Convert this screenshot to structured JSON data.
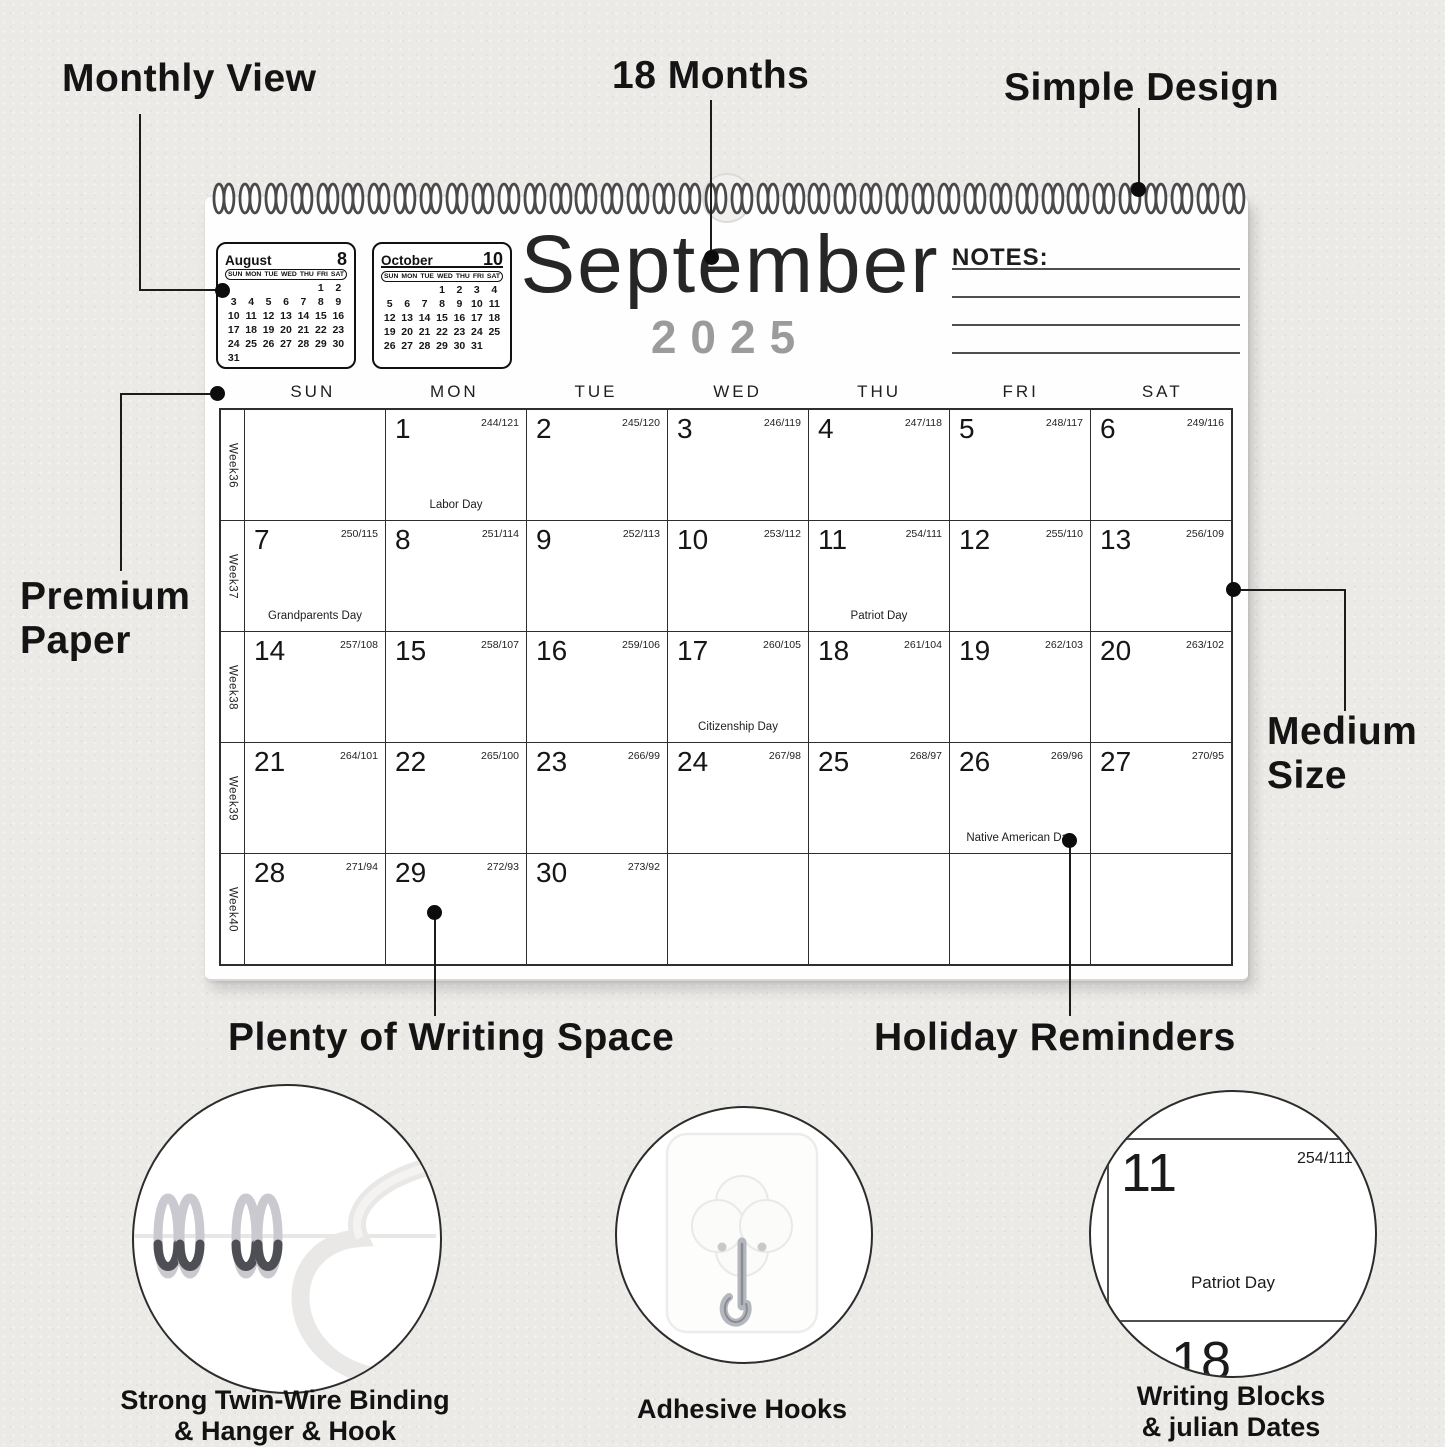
{
  "annotations": {
    "monthly_view": "Monthly View",
    "eighteen_months": "18 Months",
    "simple_design": "Simple Design",
    "premium_paper": [
      "Premium",
      "Paper"
    ],
    "medium_size": [
      "Medium",
      "Size"
    ],
    "writing_space": "Plenty of Writing Space",
    "holiday_reminders": "Holiday Reminders"
  },
  "calendar": {
    "title": "September",
    "year": "2025",
    "notes_label": "NOTES:",
    "day_headers": [
      "SUN",
      "MON",
      "TUE",
      "WED",
      "THU",
      "FRI",
      "SAT"
    ],
    "weeks": [
      {
        "label": "Week36",
        "cells": [
          {},
          {
            "day": "1",
            "julian": "244/121",
            "holiday": "Labor Day"
          },
          {
            "day": "2",
            "julian": "245/120"
          },
          {
            "day": "3",
            "julian": "246/119"
          },
          {
            "day": "4",
            "julian": "247/118"
          },
          {
            "day": "5",
            "julian": "248/117"
          },
          {
            "day": "6",
            "julian": "249/116"
          }
        ]
      },
      {
        "label": "Week37",
        "cells": [
          {
            "day": "7",
            "julian": "250/115",
            "holiday": "Grandparents Day"
          },
          {
            "day": "8",
            "julian": "251/114"
          },
          {
            "day": "9",
            "julian": "252/113"
          },
          {
            "day": "10",
            "julian": "253/112"
          },
          {
            "day": "11",
            "julian": "254/111",
            "holiday": "Patriot Day"
          },
          {
            "day": "12",
            "julian": "255/110"
          },
          {
            "day": "13",
            "julian": "256/109"
          }
        ]
      },
      {
        "label": "Week38",
        "cells": [
          {
            "day": "14",
            "julian": "257/108"
          },
          {
            "day": "15",
            "julian": "258/107"
          },
          {
            "day": "16",
            "julian": "259/106"
          },
          {
            "day": "17",
            "julian": "260/105",
            "holiday": "Citizenship Day"
          },
          {
            "day": "18",
            "julian": "261/104"
          },
          {
            "day": "19",
            "julian": "262/103"
          },
          {
            "day": "20",
            "julian": "263/102"
          }
        ]
      },
      {
        "label": "Week39",
        "cells": [
          {
            "day": "21",
            "julian": "264/101"
          },
          {
            "day": "22",
            "julian": "265/100"
          },
          {
            "day": "23",
            "julian": "266/99"
          },
          {
            "day": "24",
            "julian": "267/98"
          },
          {
            "day": "25",
            "julian": "268/97"
          },
          {
            "day": "26",
            "julian": "269/96",
            "holiday": "Native American Day"
          },
          {
            "day": "27",
            "julian": "270/95"
          }
        ]
      },
      {
        "label": "Week40",
        "cells": [
          {
            "day": "28",
            "julian": "271/94"
          },
          {
            "day": "29",
            "julian": "272/93"
          },
          {
            "day": "30",
            "julian": "273/92"
          },
          {},
          {},
          {},
          {}
        ]
      }
    ]
  },
  "mini_calendars": [
    {
      "month": "August",
      "number": "8",
      "day_headers": [
        "SUN",
        "MON",
        "TUE",
        "WED",
        "THU",
        "FRI",
        "SAT"
      ],
      "weeks": [
        [
          "",
          "",
          "",
          "",
          "",
          "1",
          "2"
        ],
        [
          "3",
          "4",
          "5",
          "6",
          "7",
          "8",
          "9"
        ],
        [
          "10",
          "11",
          "12",
          "13",
          "14",
          "15",
          "16"
        ],
        [
          "17",
          "18",
          "19",
          "20",
          "21",
          "22",
          "23"
        ],
        [
          "24",
          "25",
          "26",
          "27",
          "28",
          "29",
          "30"
        ],
        [
          "31",
          "",
          "",
          "",
          "",
          "",
          ""
        ]
      ]
    },
    {
      "month": "October",
      "number": "10",
      "day_headers": [
        "SUN",
        "MON",
        "TUE",
        "WED",
        "THU",
        "FRI",
        "SAT"
      ],
      "weeks": [
        [
          "",
          "",
          "",
          "1",
          "2",
          "3",
          "4"
        ],
        [
          "5",
          "6",
          "7",
          "8",
          "9",
          "10",
          "11"
        ],
        [
          "12",
          "13",
          "14",
          "15",
          "16",
          "17",
          "18"
        ],
        [
          "19",
          "20",
          "21",
          "22",
          "23",
          "24",
          "25"
        ],
        [
          "26",
          "27",
          "28",
          "29",
          "30",
          "31",
          ""
        ]
      ]
    }
  ],
  "features": {
    "binding": [
      "Strong Twin-Wire Binding",
      "& Hanger & Hook"
    ],
    "hooks": [
      "Adhesive Hooks"
    ],
    "writing": [
      "Writing Blocks",
      "& julian Dates"
    ]
  },
  "detail_cell": {
    "day": "11",
    "julian": "254/111",
    "holiday": "Patriot Day",
    "next_day": "18"
  },
  "colors": {
    "year_gray": "#9b9b9b",
    "ink": "#1b1b1b",
    "grid_line": "#2e2e2e"
  }
}
